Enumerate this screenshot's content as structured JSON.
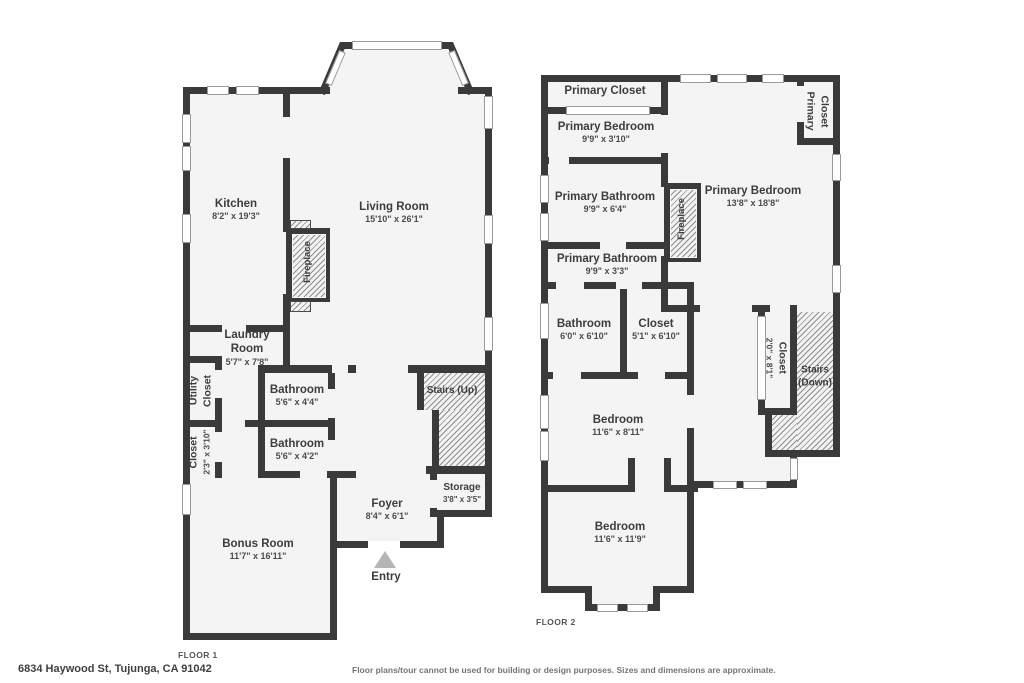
{
  "footer": {
    "address": "6834 Haywood St, Tujunga, CA 91042",
    "disclaimer": "Floor plans/tour cannot be used for building or design purposes. Sizes and dimensions are approximate."
  },
  "colors": {
    "wall": "#3a3a3a",
    "floor": "#f4f4f4",
    "hatch_line": "#8e8e8e",
    "entry_arrow": "#b5b5b5"
  },
  "floor1": {
    "caption": "FLOOR 1",
    "kitchen": {
      "name": "Kitchen",
      "dims": "8'2\" x 19'3\""
    },
    "living_room": {
      "name": "Living Room",
      "dims": "15'10\" x 26'1\""
    },
    "fireplace": {
      "name": "Fireplace"
    },
    "laundry": {
      "name": "Laundry Room",
      "dims": "5'7\" x 7'8\""
    },
    "utility_closet": {
      "line1": "Utility",
      "line2": "Closet"
    },
    "bathroom_upper": {
      "name": "Bathroom",
      "dims": "5'6\" x 4'4\""
    },
    "bathroom_lower": {
      "name": "Bathroom",
      "dims": "5'6\" x 4'2\""
    },
    "closet": {
      "name": "Closet",
      "dims": "2'3\" x 3'10\""
    },
    "bonus_room": {
      "name": "Bonus Room",
      "dims": "11'7\" x 16'11\""
    },
    "foyer": {
      "name": "Foyer",
      "dims": "8'4\" x 6'1\""
    },
    "storage": {
      "name": "Storage",
      "dims": "3'8\" x 3'5\""
    },
    "stairs": {
      "name": "Stairs (Up)"
    },
    "entry": {
      "name": "Entry"
    }
  },
  "floor2": {
    "caption": "FLOOR 2",
    "primary_closet_top": {
      "name": "Primary Closet"
    },
    "primary_bedroom_small": {
      "name": "Primary Bedroom",
      "dims": "9'9\" x 3'10\""
    },
    "primary_bathroom_large": {
      "name": "Primary Bathroom",
      "dims": "9'9\" x 6'4\""
    },
    "primary_bathroom_small": {
      "name": "Primary Bathroom",
      "dims": "9'9\" x 3'3\""
    },
    "bathroom": {
      "name": "Bathroom",
      "dims": "6'0\" x 6'10\""
    },
    "closet_small": {
      "name": "Closet",
      "dims": "5'1\" x 6'10\""
    },
    "bedroom_mid": {
      "name": "Bedroom",
      "dims": "11'6\" x 8'11\""
    },
    "bedroom_bottom": {
      "name": "Bedroom",
      "dims": "11'6\" x 11'9\""
    },
    "primary_bedroom": {
      "name": "Primary Bedroom",
      "dims": "13'8\" x 18'8\""
    },
    "primary_closet_right": {
      "line1": "Primary",
      "line2": "Closet"
    },
    "closet_tall": {
      "name": "Closet",
      "dims": "2'0\" x 8'1\""
    },
    "stairs": {
      "name": "Stairs (Down)"
    },
    "fireplace": {
      "name": "Fireplace"
    }
  }
}
